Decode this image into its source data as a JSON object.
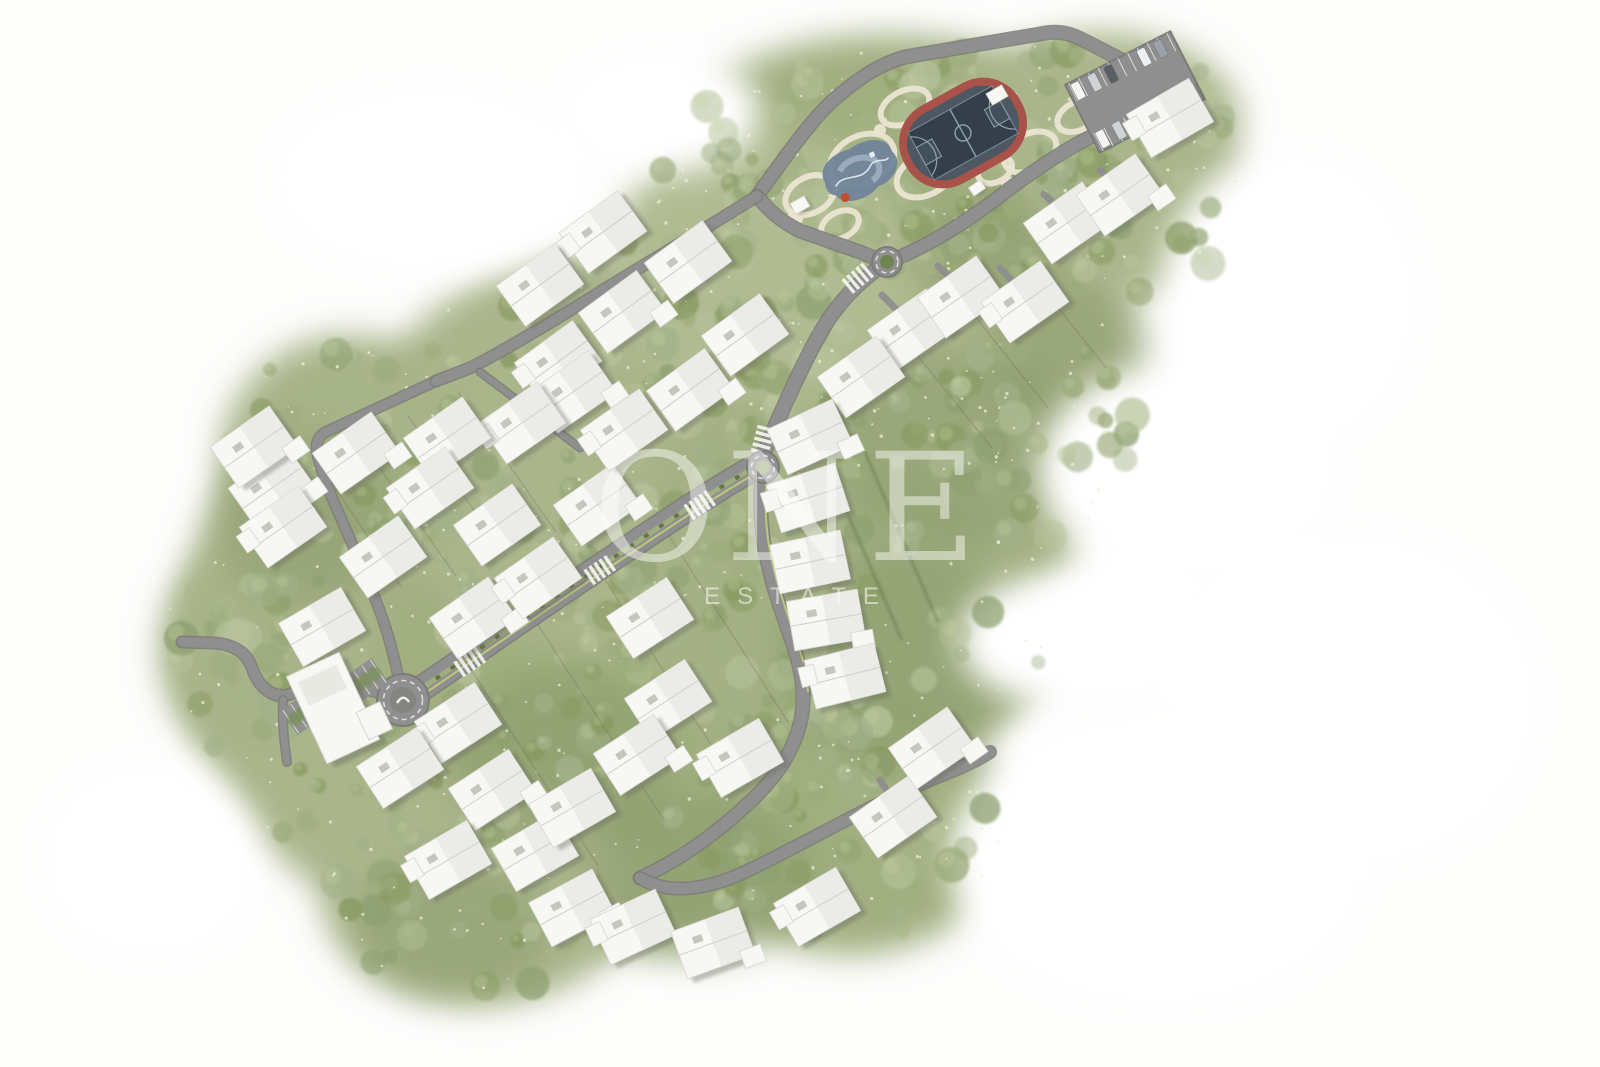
{
  "watermark": {
    "brand": "ONE",
    "subtitle": "ESTATE"
  },
  "palette": {
    "bg": "#fdfdfc",
    "green_base": "#aab58b",
    "green_alt1": "#a1af80",
    "green_alt2": "#b4bf97",
    "green_dark": "#7f915f",
    "road": "#8f8f8f",
    "road_edge": "#7b7b78",
    "road_stripe": "#c6cc79",
    "path_beige": "#eae5d2",
    "house_body": "#f7f7f4",
    "house_facet": "#e9e9e4",
    "house_shadow": "#63635c",
    "track_red": "#a8524a",
    "court_dark": "#343f4b",
    "court_mid": "#4d5862",
    "playground_blue": "#71849a",
    "playground_light": "#a9bccb",
    "white": "#ffffff"
  },
  "terrain": {
    "blobs": [
      [
        420,
        640,
        240,
        270,
        "#aab58b"
      ],
      [
        640,
        690,
        270,
        260,
        "#a1af80"
      ],
      [
        620,
        450,
        260,
        200,
        "#aab58b"
      ],
      [
        860,
        560,
        220,
        215,
        "#a4b184"
      ],
      [
        950,
        330,
        180,
        155,
        "#aab58b"
      ],
      [
        890,
        150,
        220,
        115,
        "#a1af80"
      ],
      [
        1100,
        120,
        140,
        88,
        "#aab58b"
      ],
      [
        760,
        265,
        150,
        135,
        "#b0bb92"
      ],
      [
        350,
        460,
        130,
        125,
        "#a7b388"
      ],
      [
        1050,
        430,
        110,
        100,
        "#aab58b"
      ],
      [
        850,
        820,
        160,
        135,
        "#a1af80"
      ],
      [
        480,
        890,
        160,
        115,
        "#aab58b"
      ],
      [
        240,
        650,
        80,
        100,
        "#a7b388"
      ],
      [
        1140,
        200,
        110,
        95,
        "#aab58b"
      ]
    ],
    "dark_patches": [
      [
        950,
        450,
        120,
        100
      ],
      [
        1075,
        350,
        85,
        70
      ],
      [
        900,
        655,
        125,
        110
      ],
      [
        310,
        520,
        95,
        85
      ],
      [
        700,
        880,
        115,
        85
      ],
      [
        990,
        255,
        75,
        55
      ],
      [
        560,
        760,
        110,
        90
      ],
      [
        450,
        930,
        100,
        70
      ]
    ],
    "carves": [
      [
        1190,
        470,
        150,
        110
      ],
      [
        1120,
        625,
        95,
        75
      ],
      [
        1290,
        300,
        130,
        150
      ],
      [
        660,
        112,
        100,
        62
      ],
      [
        1350,
        700,
        190,
        170
      ],
      [
        1040,
        640,
        80,
        60
      ],
      [
        1160,
        860,
        210,
        150
      ],
      [
        430,
        180,
        160,
        95
      ],
      [
        150,
        860,
        110,
        100
      ]
    ],
    "tree_colors": [
      "#8da06f",
      "#9cab7c",
      "#a9b789",
      "#b6c29a",
      "#87995f",
      "#a3b28a"
    ],
    "tree_regions": [
      [
        420,
        640,
        230,
        260,
        70
      ],
      [
        640,
        690,
        260,
        250,
        75
      ],
      [
        620,
        450,
        250,
        195,
        65
      ],
      [
        860,
        560,
        210,
        205,
        60
      ],
      [
        950,
        330,
        175,
        150,
        45
      ],
      [
        890,
        150,
        210,
        110,
        55
      ],
      [
        1100,
        120,
        135,
        85,
        28
      ],
      [
        760,
        265,
        145,
        130,
        38
      ],
      [
        350,
        460,
        125,
        120,
        30
      ],
      [
        1050,
        430,
        105,
        95,
        22
      ],
      [
        850,
        820,
        155,
        130,
        38
      ],
      [
        480,
        890,
        155,
        110,
        38
      ],
      [
        240,
        650,
        78,
        98,
        18
      ],
      [
        1140,
        200,
        105,
        92,
        24
      ]
    ]
  },
  "parcel_lines": [
    [
      470,
      668,
      598,
      866
    ],
    [
      536,
      622,
      664,
      820
    ],
    [
      604,
      578,
      726,
      768
    ],
    [
      668,
      534,
      788,
      722
    ],
    [
      905,
      340,
      992,
      448
    ],
    [
      962,
      300,
      1048,
      408
    ],
    [
      1022,
      262,
      1106,
      368
    ],
    [
      318,
      462,
      402,
      588
    ],
    [
      360,
      440,
      456,
      576
    ],
    [
      408,
      416,
      506,
      556
    ],
    [
      458,
      392,
      556,
      532
    ]
  ],
  "hedges": [
    [
      828,
      468,
      902,
      640
    ],
    [
      865,
      452,
      938,
      622
    ]
  ],
  "roads": {
    "main": [
      {
        "d": "M757,196 C790,150 815,115 838,96 C862,76 880,64 905,57 L1040,34 C1058,30 1070,33 1085,41 L1118,58 C1165,82 1185,92 1192,100 C1198,108 1196,118 1188,126",
        "w": 12
      },
      {
        "d": "M757,196 C770,212 782,222 800,231 L860,252 C872,257 880,260 887,262",
        "w": 12
      },
      {
        "d": "M887,262 C920,250 955,230 1000,196 C1050,158 1095,130 1130,122 L1186,108",
        "w": 12
      },
      {
        "d": "M887,262 C860,280 838,302 822,330 C800,368 778,420 765,450",
        "w": 13
      },
      {
        "d": "M763,467 C757,510 763,550 774,588 C788,634 801,658 803,692 C805,728 788,766 752,800 C714,836 676,862 640,878",
        "w": 12
      },
      {
        "d": "M640,878 C665,893 700,893 745,872 C800,846 870,805 930,780 C955,770 975,762 990,752",
        "w": 11
      },
      {
        "d": "M403,700 C380,693 360,686 340,684 C315,681 300,692 287,695 C270,698 258,685 252,668 C247,653 235,645 215,643 L182,642",
        "w": 10
      },
      {
        "d": "M283,700 C282,722 284,742 287,762",
        "w": 7
      },
      {
        "d": "M403,700 C396,662 388,632 378,606 C366,574 352,544 340,516 C330,494 320,468 317,452 C315,440 320,434 330,430 L436,381",
        "w": 9
      },
      {
        "d": "M757,196 C720,220 660,255 600,292 C555,320 505,350 470,368 L436,381",
        "w": 10
      },
      {
        "d": "M480,372 C515,398 548,424 580,448",
        "w": 6
      }
    ],
    "avenue": {
      "d": "M421,689 C500,635 560,593 625,550 C680,513 720,487 750,470",
      "w": 24
    },
    "stripes": [
      {
        "d": "M768,472 C762,512 768,552 779,588 C793,634 806,658 808,692",
        "w": 2
      },
      {
        "d": "M424,694 C503,640 563,598 628,555 C683,518 723,492 753,475",
        "w": 2
      }
    ],
    "crosswalks": [
      [
        470,
        662,
        -34
      ],
      [
        600,
        570,
        -34
      ],
      [
        700,
        505,
        -34
      ],
      [
        763,
        440,
        -75
      ],
      [
        858,
        278,
        -40
      ]
    ],
    "driveways": [
      [
        905,
        318,
        882,
        295
      ],
      [
        958,
        285,
        938,
        266
      ],
      [
        1020,
        290,
        1000,
        268
      ],
      [
        1063,
        212,
        1044,
        194
      ],
      [
        1116,
        185,
        1100,
        170
      ],
      [
        800,
        498,
        779,
        496
      ],
      [
        801,
        562,
        782,
        560
      ],
      [
        816,
        620,
        795,
        615
      ],
      [
        834,
        673,
        806,
        664
      ],
      [
        893,
        800,
        880,
        780
      ],
      [
        862,
        390,
        850,
        372
      ]
    ]
  },
  "roundabouts": [
    {
      "x": 403,
      "y": 700,
      "r": 26,
      "inner": 13,
      "kind": "large"
    },
    {
      "x": 763,
      "y": 467,
      "r": 16,
      "inner": 7,
      "kind": "small"
    },
    {
      "x": 887,
      "y": 262,
      "r": 15,
      "inner": 7,
      "kind": "green"
    }
  ],
  "park": {
    "cells": [
      [
        810,
        195,
        26,
        18
      ],
      [
        862,
        160,
        34,
        24
      ],
      [
        925,
        175,
        30,
        20
      ],
      [
        968,
        122,
        40,
        26
      ],
      [
        1030,
        152,
        28,
        18
      ],
      [
        905,
        107,
        26,
        16
      ],
      [
        1078,
        116,
        22,
        14
      ],
      [
        840,
        225,
        20,
        13
      ],
      [
        995,
        170,
        18,
        12
      ]
    ],
    "plazas": [
      [
        795,
        218,
        8
      ],
      [
        1008,
        183,
        7
      ],
      [
        880,
        130,
        6
      ]
    ],
    "court": {
      "x": 963,
      "y": 133,
      "rot": -29,
      "w": 96,
      "h": 54
    },
    "playground": {
      "x": 862,
      "y": 172,
      "rot": -25
    },
    "pavilions": [
      [
        800,
        205,
        -30,
        16,
        12
      ],
      [
        997,
        95,
        -30,
        18,
        13
      ],
      [
        977,
        188,
        -35,
        14,
        10
      ]
    ]
  },
  "parking": {
    "main": {
      "x": 1135,
      "y": 92,
      "rot": -27,
      "w": 118,
      "h": 76,
      "car_colors": [
        "#f4f4f2",
        "#cfd3d6",
        "#585f66",
        "#d9cdb4",
        "#eceff1",
        "#9aa1a8"
      ]
    },
    "small": [
      {
        "x": 303,
        "y": 713,
        "rot": -35
      },
      {
        "x": 366,
        "y": 680,
        "rot": -35
      }
    ]
  },
  "buildings": {
    "houses": [
      [
        911,
        330,
        -35
      ],
      [
        961,
        297,
        -35
      ],
      [
        1025,
        302,
        -35
      ],
      [
        1067,
        223,
        -35
      ],
      [
        1120,
        195,
        -35
      ],
      [
        1170,
        118,
        -30
      ],
      [
        861,
        377,
        -35
      ],
      [
        810,
        437,
        -25
      ],
      [
        808,
        498,
        -18
      ],
      [
        810,
        562,
        -12
      ],
      [
        826,
        620,
        -10
      ],
      [
        845,
        676,
        -14
      ],
      [
        688,
        262,
        -36
      ],
      [
        622,
        312,
        -36
      ],
      [
        558,
        362,
        -36
      ],
      [
        745,
        335,
        -36
      ],
      [
        690,
        390,
        -36
      ],
      [
        603,
        232,
        -36
      ],
      [
        540,
        285,
        -36
      ],
      [
        573,
        392,
        -35
      ],
      [
        522,
        423,
        -35
      ],
      [
        447,
        438,
        -35
      ],
      [
        356,
        453,
        -35
      ],
      [
        430,
        488,
        -35
      ],
      [
        497,
        525,
        -35
      ],
      [
        597,
        505,
        -35
      ],
      [
        624,
        430,
        -35
      ],
      [
        383,
        557,
        -35
      ],
      [
        473,
        618,
        -35
      ],
      [
        538,
        578,
        -35
      ],
      [
        650,
        618,
        -33
      ],
      [
        272,
        488,
        -35
      ],
      [
        283,
        527,
        -35
      ],
      [
        322,
        627,
        -30
      ],
      [
        254,
        447,
        -35
      ],
      [
        458,
        723,
        -33
      ],
      [
        400,
        768,
        -33
      ],
      [
        492,
        790,
        -33
      ],
      [
        448,
        860,
        -30
      ],
      [
        535,
        852,
        -30
      ],
      [
        572,
        908,
        -28
      ],
      [
        633,
        927,
        -25
      ],
      [
        572,
        808,
        -30
      ],
      [
        713,
        943,
        -20
      ],
      [
        817,
        907,
        -30
      ],
      [
        893,
        817,
        -35
      ],
      [
        932,
        748,
        -35
      ],
      [
        740,
        758,
        -30
      ],
      [
        668,
        700,
        -33
      ],
      [
        637,
        755,
        -33
      ]
    ],
    "clubhouse": {
      "x": 333,
      "y": 708,
      "rot": -25,
      "w": 58,
      "h": 96
    }
  }
}
